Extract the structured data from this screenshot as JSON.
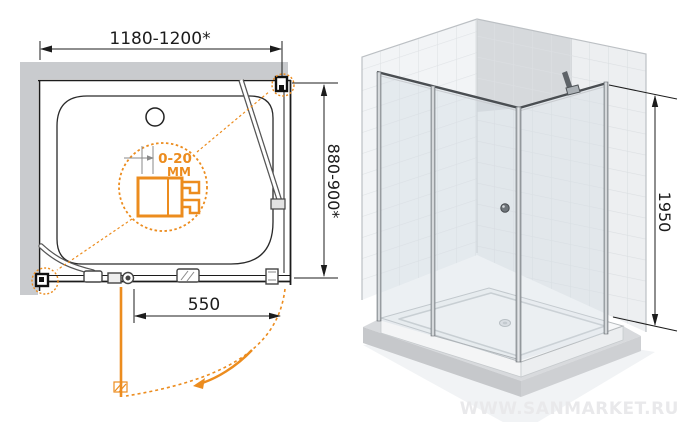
{
  "views": {
    "plan": {
      "width_dim": "1180-1200*",
      "depth_dim": "880-900*",
      "door_width_dim": "550",
      "detail_callout": {
        "line1": "0-20",
        "line2": "ММ"
      }
    },
    "iso": {
      "height_dim": "1950"
    }
  },
  "watermark": "WWW.SANMARKET.RU",
  "colors": {
    "accent_orange": "#ec8c1e",
    "wall_gray": "#c9cbce",
    "line_black": "#1c1c1c",
    "watermark_gray": "#e9e9eb"
  }
}
